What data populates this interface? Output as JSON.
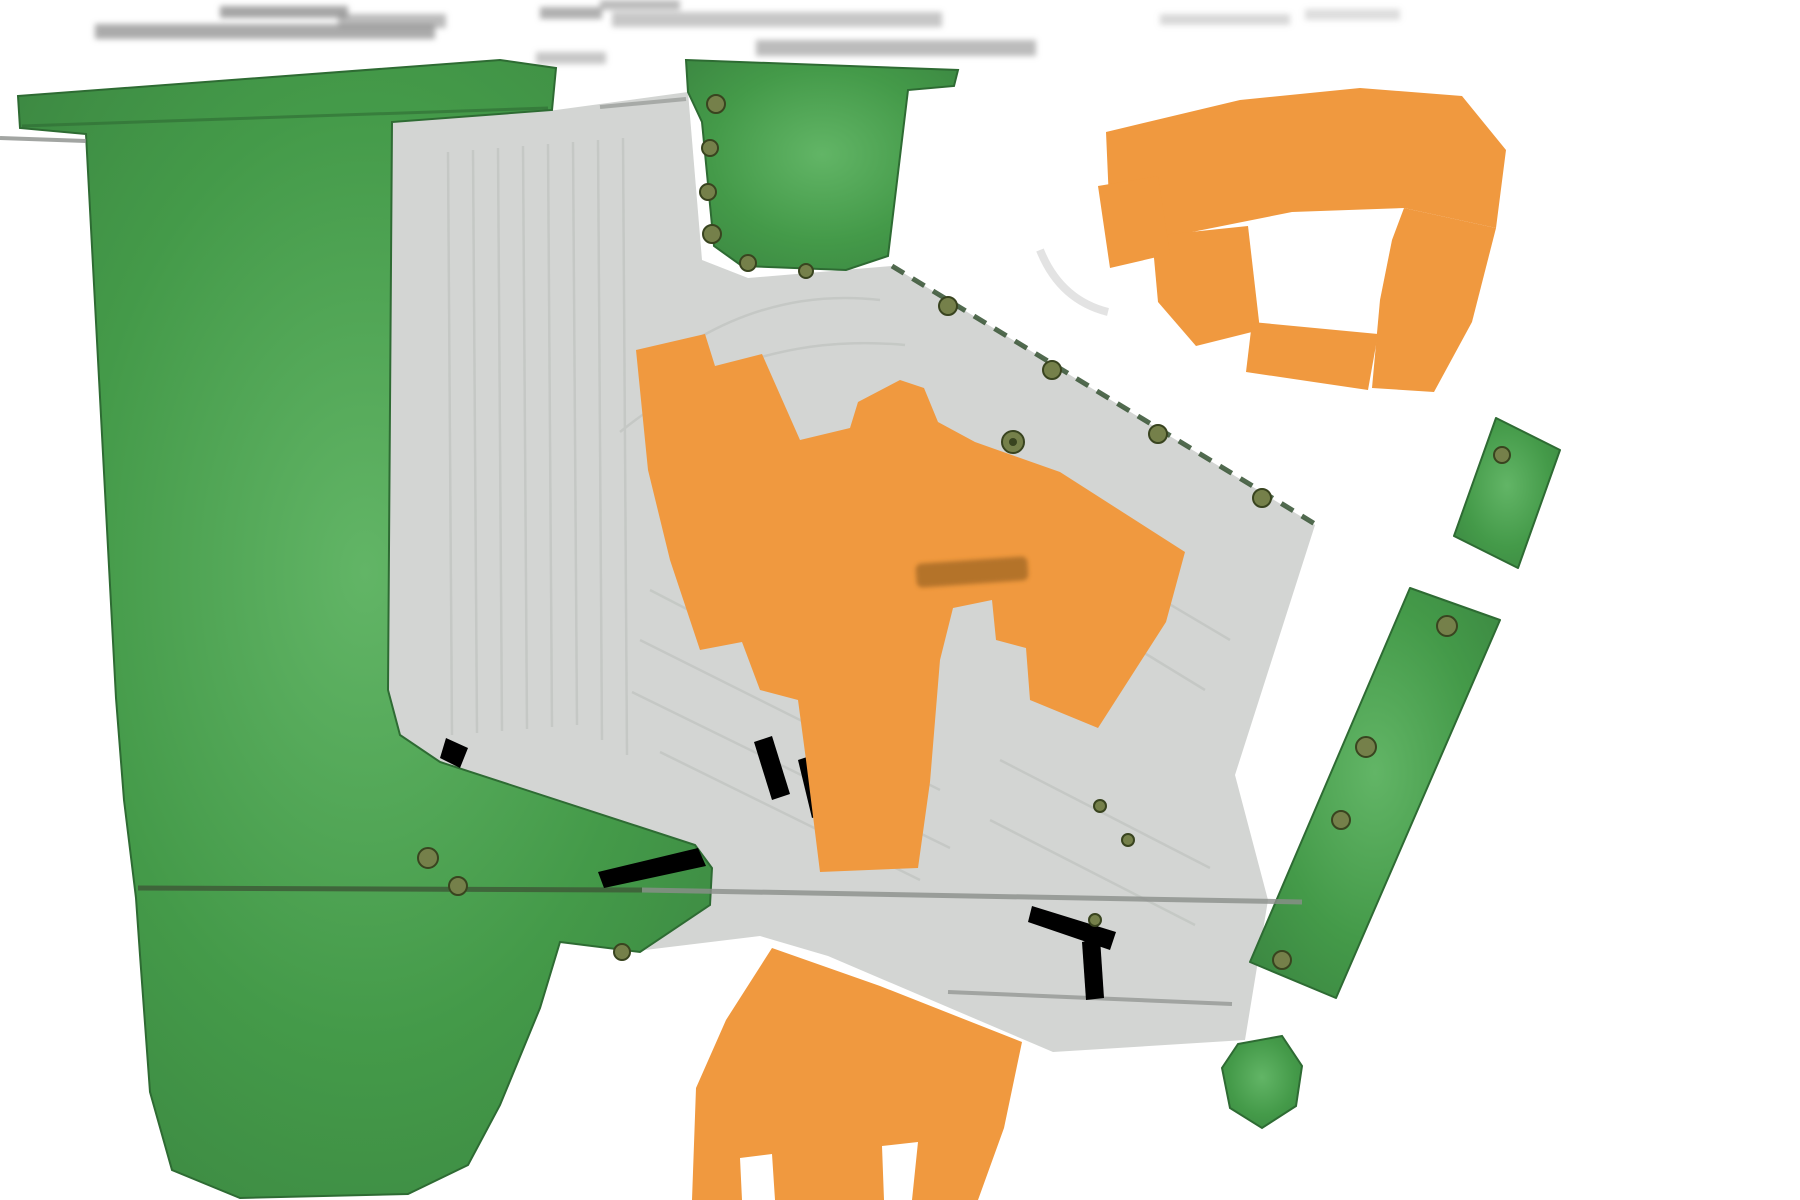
{
  "page": {
    "kind": "site-plan-drawing",
    "description": "Low-resolution colored landscape site plan: large green lawn areas, gray parking lot rotated diagonally, orange building footprints, olive tree symbols, dashed property boundary",
    "background": "#ffffff"
  },
  "palette": {
    "bg": "#ffffff",
    "grass_green": "#449a49",
    "grass_light": "#62b566",
    "grass_dark": "#2e6b33",
    "tree_olive": "#75804a",
    "tree_dark_olive": "#39441f",
    "pavement_gray": "#d3d5d3",
    "lane_line_gray": "#c2c5c2",
    "road_line_gray": "#8b8e8b",
    "building_orange": "#f0993f",
    "building_label_orange": "#aa6d28",
    "boundary_green": "#3f5a3c",
    "title_text_gray": "#8f8f8f"
  },
  "regions": {
    "title_block": {
      "legible": false,
      "lines": 3,
      "note": "blurred illegible drawing title text across top"
    },
    "west_lawn": {
      "type": "grass",
      "shape": "large T-shaped lawn with top bar and long column, rounded bottom"
    },
    "north_lawn_patch": {
      "type": "grass",
      "shape": "trapezoid lawn pad with tree row on west edge"
    },
    "parking_lot": {
      "type": "pavement",
      "shape": "rotated parking field with faint stall striping"
    },
    "central_building": {
      "type": "building",
      "label_legible": false
    },
    "northeast_building": {
      "type": "building",
      "shape": "hooked footprint with white notch"
    },
    "south_building": {
      "type": "building",
      "shape": "partially off-canvas with entry notches"
    },
    "east_green_strips": {
      "type": "grass",
      "count": 2
    },
    "southeast_green_blob": {
      "type": "grass",
      "count": 1
    },
    "boundary": {
      "style": "dashed dark green with tree circles"
    },
    "road_lines": {
      "count": 3
    }
  }
}
